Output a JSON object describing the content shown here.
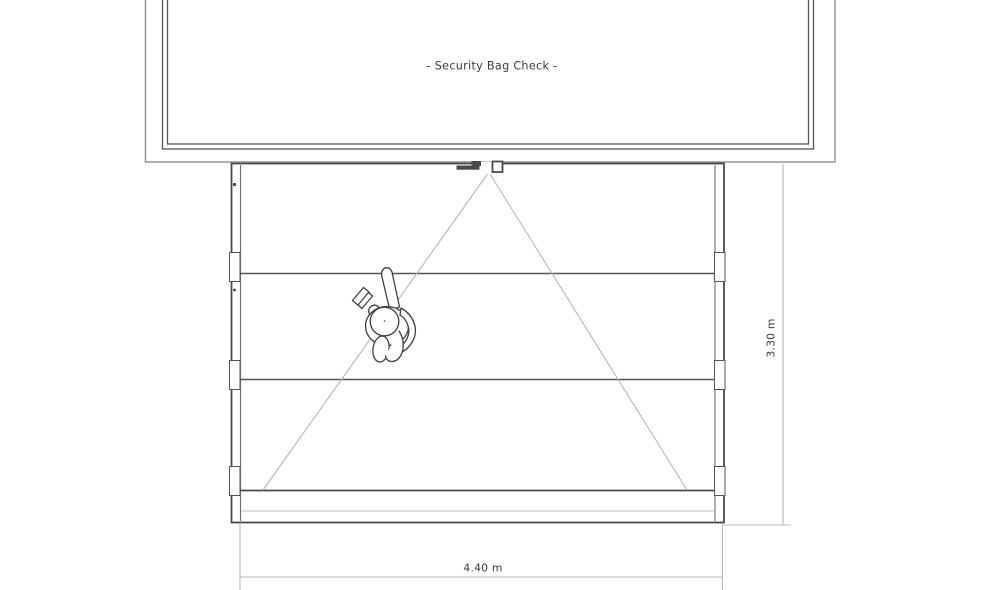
{
  "page": {
    "background": "#ffffff"
  },
  "drawing": {
    "area_label": "- Security Bag Check -",
    "dimensions": {
      "width_label": "4.40 m",
      "height_label": "3.30 m"
    },
    "colors": {
      "line_dark": "#4a4a4a",
      "line_medium": "#8e8e8e",
      "line_light": "#b8b8b8",
      "text": "#3b3b3b",
      "background": "#ffffff"
    }
  }
}
